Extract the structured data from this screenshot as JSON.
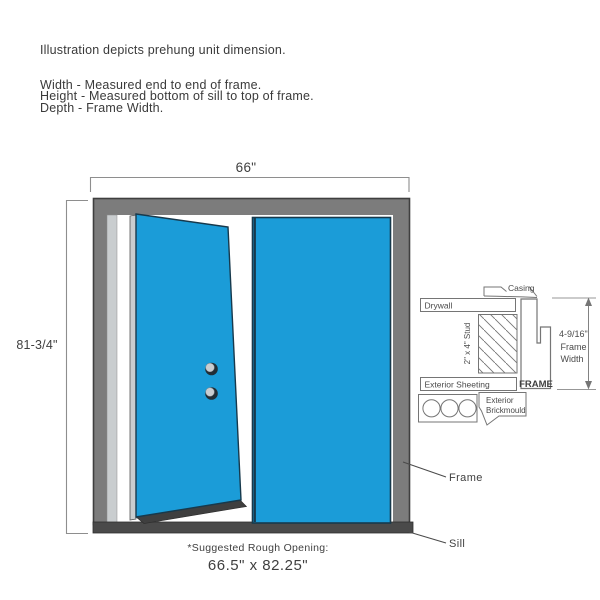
{
  "intro": {
    "line1": "Illustration depicts prehung unit dimension.",
    "width_line": "Width - Measured end to end of frame.",
    "height_line": "Height - Measured bottom of sill to top of frame.",
    "depth_line": "Depth - Frame Width."
  },
  "door_diagram": {
    "width_dimension": "66\"",
    "height_dimension": "81-3/4\"",
    "frame_callout": "Frame",
    "sill_callout": "Sill",
    "rough_opening_caption": "*Suggested Rough Opening:",
    "rough_opening_value": "66.5\" x 82.25\"",
    "colors": {
      "door_blue": "#1B9CD8",
      "door_edge_navy": "#14455E",
      "frame_gray": "#7C7C7C",
      "sill_gray": "#4A4A4A",
      "jamb_light_gray": "#C9CDCF"
    }
  },
  "cross_section": {
    "casing": "Casing",
    "drywall": "Drywall",
    "stud": "2\" x 4\" Stud",
    "exterior_sheeting": "Exterior Sheeting",
    "frame": "FRAME",
    "exterior_brickmould_line1": "Exterior",
    "exterior_brickmould_line2": "Brickmould",
    "frame_width_dimension": "4-9/16\"",
    "frame_width_label_line1": "Frame",
    "frame_width_label_line2": "Width"
  }
}
